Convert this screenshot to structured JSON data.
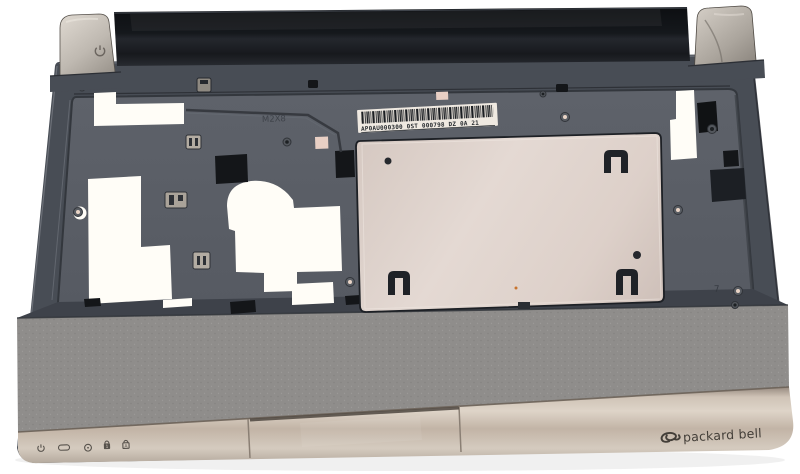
{
  "photo": {
    "subject": "laptop-palmrest-top-cover-interior",
    "background_color": "#ffffff"
  },
  "branding": {
    "logo_text": "packard bell"
  },
  "labels": {
    "barcode_text": "AP0AU000300 0ST 000798 DZ  0A 21",
    "embossed_mark_m2x8": "M2X8",
    "embossed_mark_7": "7"
  },
  "indicator_icons": [
    {
      "name": "power-indicator-icon"
    },
    {
      "name": "battery-indicator-icon"
    },
    {
      "name": "disk-activity-indicator-icon"
    },
    {
      "name": "num-lock-indicator-icon",
      "glyph": "1"
    },
    {
      "name": "caps-lock-indicator-icon",
      "glyph": "A"
    }
  ],
  "colors": {
    "body_plastic": "#484d55",
    "interior_floor": "#5b5f67",
    "rear_bar_black": "#17191d",
    "metal_plate": "#ddd0c9",
    "front_strip_silver": "#c9bcae",
    "hinge_tab_silver": "#c2bcb4",
    "cutout_white": "#fffdf7",
    "label_white": "#efe9e1",
    "icon_ink": "#57524c"
  }
}
